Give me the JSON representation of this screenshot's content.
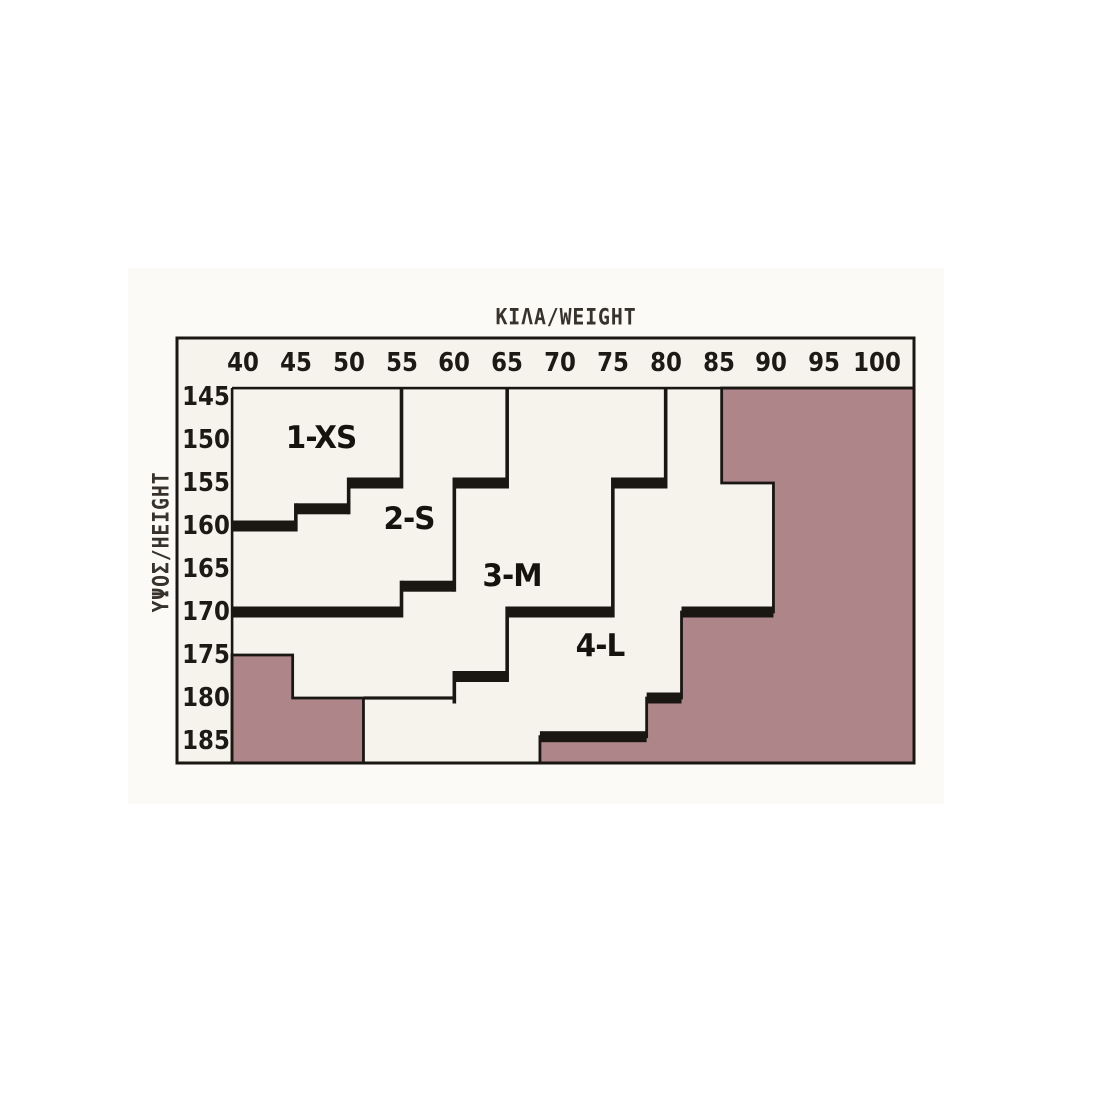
{
  "figure": {
    "top_axis_title": "ΚΙΛΑ/WEIGHT",
    "left_axis_title": "ΥΨΟΣ/HEIGHT",
    "colors": {
      "excluded_fill": "#ae8689",
      "line": "#1a1713",
      "paper": "#f6f3ec",
      "page_background": "#ffffff",
      "text": "#1d1a16"
    }
  },
  "chart_data": {
    "type": "heatmap",
    "title": "ΚΙΛΑ/WEIGHT",
    "xlabel": "ΚΙΛΑ/WEIGHT",
    "ylabel": "ΥΨΟΣ/HEIGHT",
    "x_ticks": [
      40,
      45,
      50,
      55,
      60,
      65,
      70,
      75,
      80,
      85,
      90,
      95,
      100
    ],
    "y_ticks": [
      145,
      150,
      155,
      160,
      165,
      170,
      175,
      180,
      185
    ],
    "xlim": [
      39,
      103.5
    ],
    "ylim": [
      144,
      187.5
    ],
    "grid": false,
    "legend_position": "none",
    "zones": [
      {
        "label": "1-XS",
        "pos": [
          47.4,
          149.8
        ]
      },
      {
        "label": "2-S",
        "pos": [
          55.7,
          159.2
        ]
      },
      {
        "label": "3-M",
        "pos": [
          65.5,
          165.8
        ]
      },
      {
        "label": "4-L",
        "pos": [
          73.8,
          174.0
        ]
      }
    ],
    "boundaries": [
      {
        "between": [
          "1-XS",
          "2-S"
        ],
        "segments": [
          {
            "v": 55,
            "from": "T",
            "to": 155
          },
          {
            "h": 155,
            "from": 50,
            "to": 55,
            "thick": true
          },
          {
            "v": 50,
            "from": 155,
            "to": 158
          },
          {
            "h": 158,
            "from": 45,
            "to": 50,
            "thick": true
          },
          {
            "v": 45,
            "from": 158,
            "to": 160
          },
          {
            "h": 160,
            "from": "L",
            "to": 45,
            "thick": true
          }
        ]
      },
      {
        "between": [
          "2-S",
          "3-M"
        ],
        "segments": [
          {
            "v": 65,
            "from": "T",
            "to": 155
          },
          {
            "h": 155,
            "from": 60,
            "to": 65,
            "thick": true
          },
          {
            "v": 60,
            "from": 155,
            "to": 167
          },
          {
            "h": 167,
            "from": 55,
            "to": 60,
            "thick": true
          },
          {
            "v": 55,
            "from": 167,
            "to": 170
          },
          {
            "h": 170,
            "from": "L",
            "to": 55,
            "thick": true
          }
        ]
      },
      {
        "between": [
          "3-M",
          "4-L"
        ],
        "segments": [
          {
            "v": 80,
            "from": "T",
            "to": 155
          },
          {
            "h": 155,
            "from": 75,
            "to": 80,
            "thick": true
          },
          {
            "v": 75,
            "from": 155,
            "to": 170
          },
          {
            "h": 170,
            "from": 65,
            "to": 75,
            "thick": true
          },
          {
            "v": 65,
            "from": 170,
            "to": 177.5
          },
          {
            "h": 177.5,
            "from": 60,
            "to": 65,
            "thick": true
          },
          {
            "v": 60,
            "from": 177.5,
            "to": 180
          },
          {
            "h": 180,
            "from": 51.4,
            "to": 60,
            "thick": false
          }
        ]
      },
      {
        "between": [
          "4-L",
          "out-of-range"
        ],
        "segments": [
          {
            "h": 170,
            "from": 81.5,
            "to": 90.2,
            "thick": true
          },
          {
            "h": 180,
            "from": 78.2,
            "to": 81.5,
            "thick": true
          },
          {
            "h": 184.5,
            "from": 68.1,
            "to": 78.2,
            "thick": true
          }
        ]
      }
    ],
    "excluded_zones": [
      {
        "name": "out-of-range-bottom-left",
        "polygon": [
          [
            "L",
            175
          ],
          [
            44.7,
            175
          ],
          [
            44.7,
            180
          ],
          [
            51.4,
            180
          ],
          [
            51.4,
            "B"
          ],
          [
            "L",
            "B"
          ]
        ]
      },
      {
        "name": "out-of-range-right",
        "polygon": [
          [
            85.3,
            "T"
          ],
          [
            "R",
            "T"
          ],
          [
            "R",
            "B"
          ],
          [
            68.1,
            "B"
          ],
          [
            68.1,
            184.5
          ],
          [
            78.2,
            184.5
          ],
          [
            78.2,
            180
          ],
          [
            81.5,
            180
          ],
          [
            81.5,
            170
          ],
          [
            90.2,
            170
          ],
          [
            90.2,
            155
          ],
          [
            85.3,
            155
          ]
        ]
      }
    ]
  }
}
